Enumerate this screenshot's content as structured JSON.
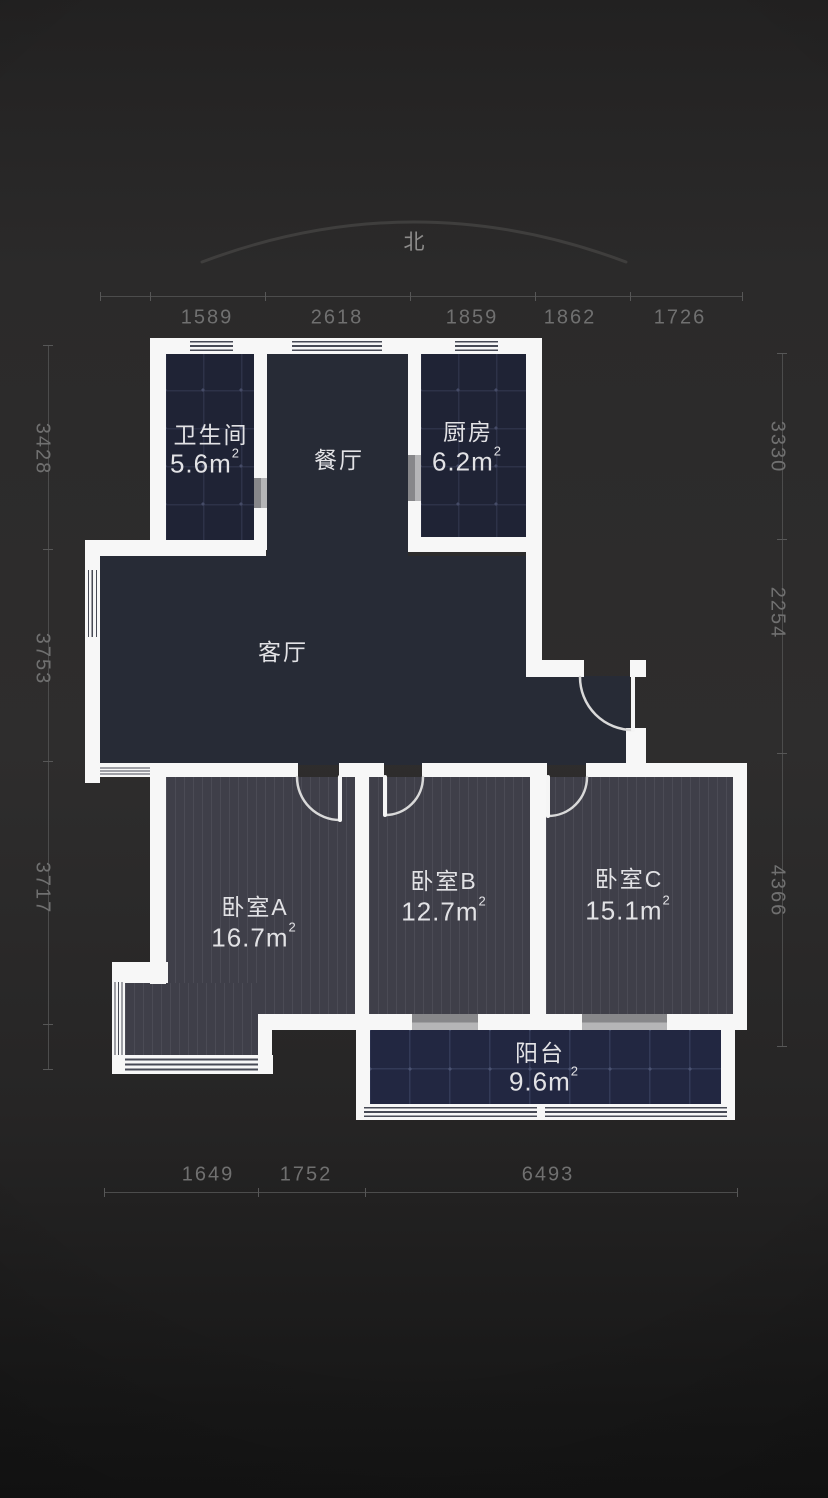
{
  "compass": {
    "north_label": "北"
  },
  "rooms": {
    "bathroom": {
      "name": "卫生间",
      "area": "5.6m",
      "area_sup": "2"
    },
    "dining": {
      "name": "餐厅"
    },
    "kitchen": {
      "name": "厨房",
      "area": "6.2m",
      "area_sup": "2"
    },
    "living": {
      "name": "客厅"
    },
    "bedroom_a": {
      "name": "卧室A",
      "area": "16.7m",
      "area_sup": "2"
    },
    "bedroom_b": {
      "name": "卧室B",
      "area": "12.7m",
      "area_sup": "2"
    },
    "bedroom_c": {
      "name": "卧室C",
      "area": "15.1m",
      "area_sup": "2"
    },
    "balcony": {
      "name": "阳台",
      "area": "9.6m",
      "area_sup": "2"
    }
  },
  "dimensions": {
    "top": [
      "1589",
      "2618",
      "1859",
      "1862",
      "1726"
    ],
    "left": [
      "3428",
      "3753",
      "3717"
    ],
    "right": [
      "3330",
      "2254",
      "4366"
    ],
    "bottom": [
      "1649",
      "1752",
      "6493"
    ]
  },
  "colors": {
    "background": "#2d2c2c",
    "wall": "#f7f7f7",
    "tile_floor": "#1f2335",
    "wood_floor": "#3f3f49",
    "living_floor": "#272b36",
    "dimension_text": "#707070",
    "room_text": "#e2e2e5"
  }
}
